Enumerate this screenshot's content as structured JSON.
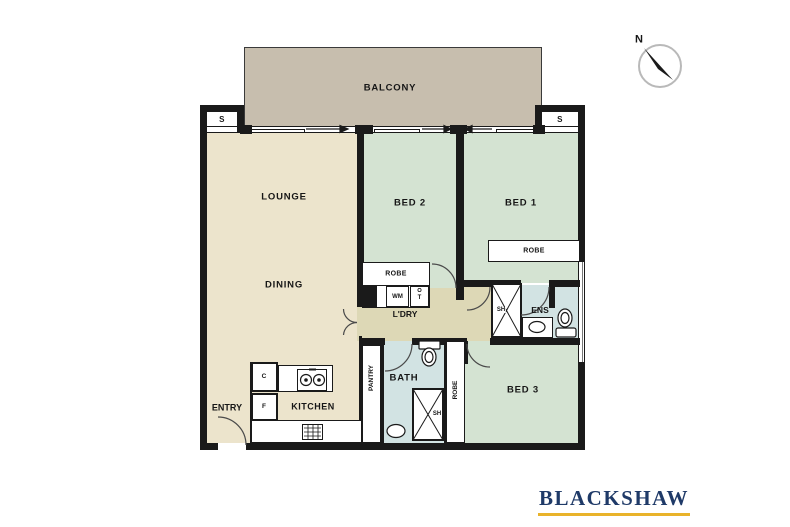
{
  "rooms": {
    "balcony": "BALCONY",
    "lounge": "LOUNGE",
    "dining": "DINING",
    "bed1": "BED 1",
    "bed2": "BED 2",
    "bed3": "BED 3",
    "laundry": "L'DRY",
    "bath": "BATH",
    "ensuite": "ENS",
    "kitchen": "KITCHEN",
    "entry": "ENTRY",
    "pantry": "PANTRY"
  },
  "storage": {
    "left": "S",
    "right": "S"
  },
  "fixtures": {
    "robe_bed1": "ROBE",
    "robe_bed2": "ROBE",
    "robe_bed3": "ROBE",
    "washing_machine": "WM",
    "dryer": "T",
    "shower_ensuite": "SH",
    "shower_bath": "SH",
    "cupboard": "C",
    "fridge": "F"
  },
  "compass": {
    "north": "N"
  },
  "branding": {
    "name": "BLACKSHAW"
  },
  "colors": {
    "balcony_floor": "#c7beae",
    "living_floor": "#ece4cc",
    "bedroom_floor": "#d4e3d2",
    "wet_area_floor": "#d2e3e3",
    "hall_floor": "#ddd8b6",
    "wall": "#1a1a1a",
    "brand_navy": "#1f3a68",
    "brand_gold": "#e9b32a"
  }
}
